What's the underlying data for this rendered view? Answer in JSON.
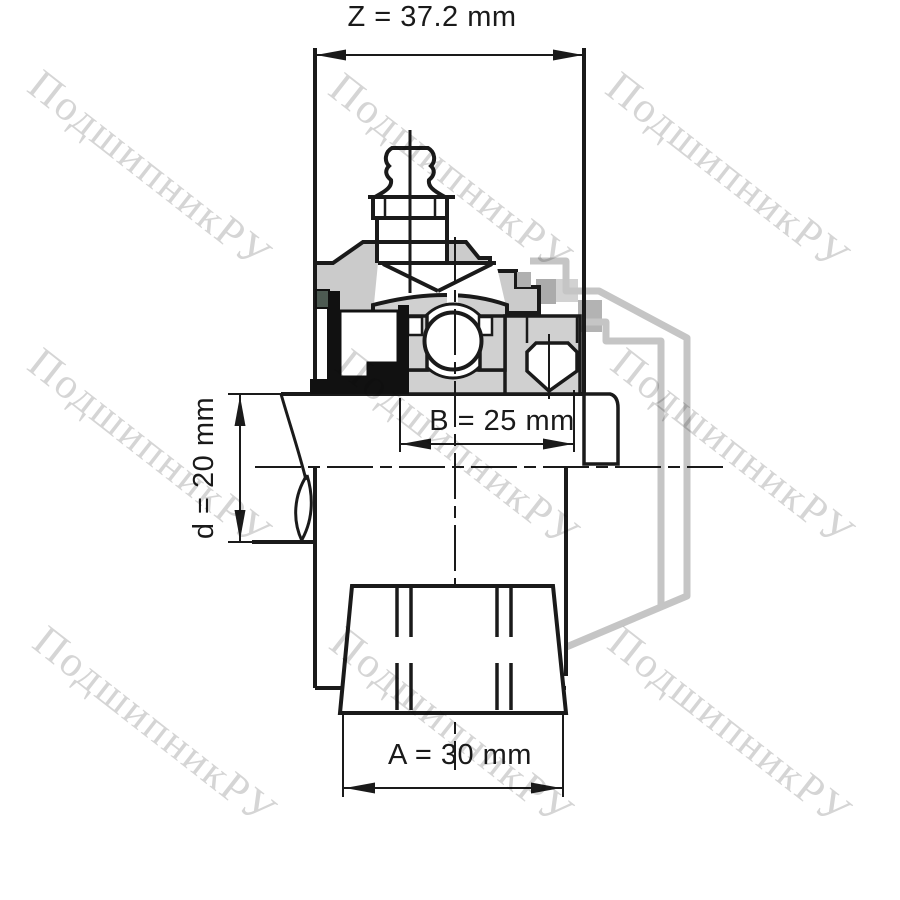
{
  "drawing": {
    "type": "bearing-unit-technical-drawing",
    "dimensions": {
      "width_z": "Z = 37.2 mm",
      "insert_width_b": "B = 25 mm",
      "bore_d": "d = 20 mm",
      "slot_width_a": "A = 30 mm"
    },
    "watermark": "ПодшипникРУ",
    "colors": {
      "line": "#1a1a1a",
      "housing_fill": "#cbcbcb",
      "insert_fill": "#d0d0d0",
      "seal_black": "#111111",
      "seal_accent": "#4d5a52",
      "ghost": "#c5c5c5",
      "watermark": "#d5d5d5",
      "background": "#ffffff"
    }
  }
}
